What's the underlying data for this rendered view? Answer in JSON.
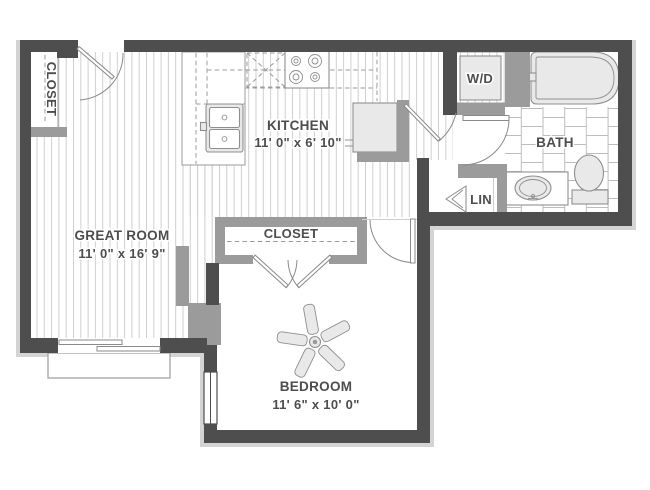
{
  "floor_plan": {
    "rooms": {
      "great_room": {
        "name": "GREAT ROOM",
        "dimensions": "11' 0\" x 16' 9\""
      },
      "kitchen": {
        "name": "KITCHEN",
        "dimensions": "11' 0\" x 6' 10\""
      },
      "bedroom": {
        "name": "BEDROOM",
        "dimensions": "11' 6\" x 10' 0\""
      },
      "bath": {
        "name": "BATH"
      },
      "entry_closet": {
        "name": "CLOSET"
      },
      "bedroom_closet": {
        "name": "CLOSET"
      },
      "washer_dryer": {
        "name": "W/D"
      },
      "linen_closet": {
        "name": "LIN"
      }
    },
    "colors": {
      "wall_dark": "#4e4e4e",
      "wall_medium": "#9b9b9b",
      "floor_line": "#cfcfcf",
      "tile_line": "#bdbdbd",
      "fixture_line": "#8f8f8f",
      "fixture_fill": "#e9e9e9",
      "door_line": "#8a8a8a",
      "text": "#4d4d4d",
      "background": "#ffffff",
      "shadow": "#d4d4d4"
    }
  }
}
